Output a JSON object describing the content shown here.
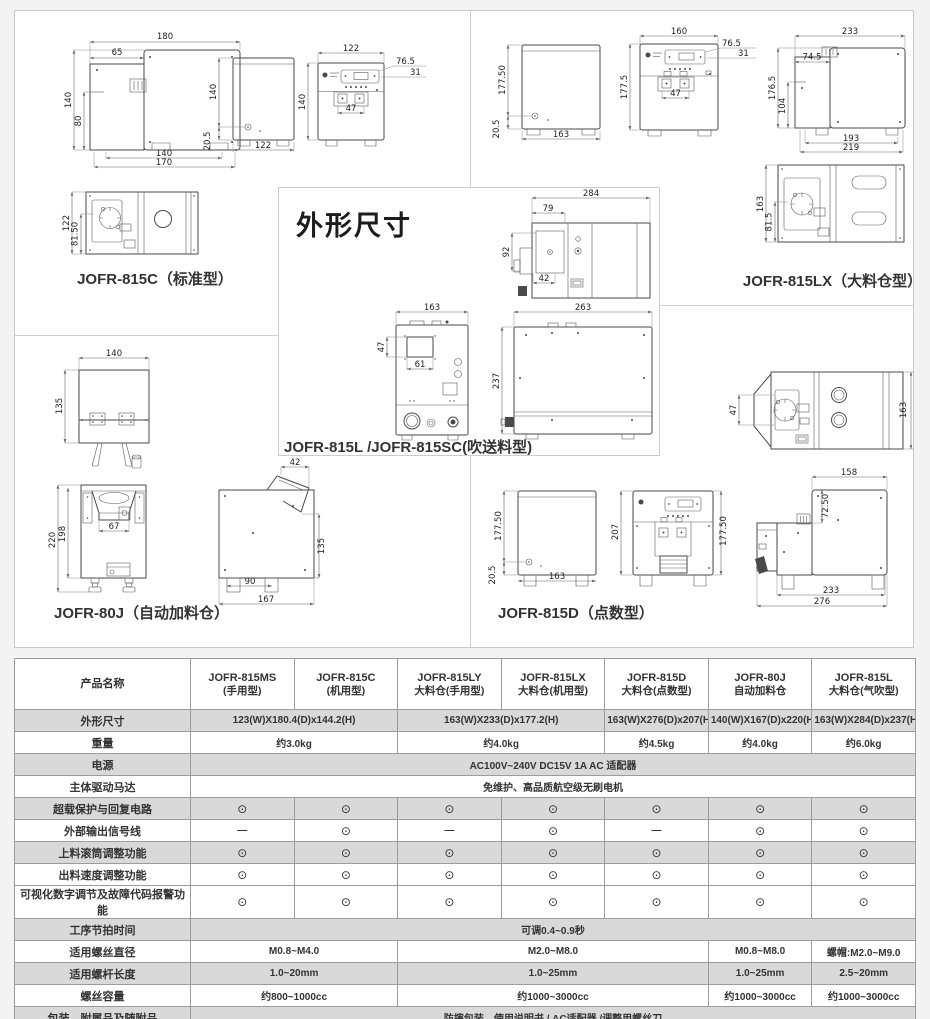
{
  "section_title": "外形尺寸",
  "labels": {
    "c815": "JOFR-815C（标准型）",
    "lx": "JOFR-815LX（大料仓型）",
    "l": "JOFR-815L /JOFR-815SC(吹送料型)",
    "j80": "JOFR-80J（自动加料仓）",
    "d815": "JOFR-815D（点数型）"
  },
  "dims": {
    "c815_side": {
      "top": "180",
      "upper": "65",
      "left": "140",
      "left2": "80",
      "bottom1": "140",
      "bottom2": "170"
    },
    "c815_rear": {
      "left": "140",
      "left2": "20.5",
      "bottom": "122"
    },
    "c815_front": {
      "top": "122",
      "right1": "76.5",
      "right2": "31",
      "left": "140",
      "inner": "47"
    },
    "c815_top": {
      "left": "122",
      "left2": "81.50"
    },
    "lx_rear": {
      "left": "177.50",
      "left2": "20.5",
      "bottom": "163"
    },
    "lx_front": {
      "top": "160",
      "right1": "76.5",
      "right2": "31",
      "left": "177.5",
      "inner": "47"
    },
    "lx_side": {
      "top": "233",
      "upper": "74.5",
      "left": "176.5",
      "left2": "104",
      "bottom1": "193",
      "bottom2": "219"
    },
    "lx_top": {
      "left": "163",
      "left2": "81.5"
    },
    "l_top": {
      "top": "284",
      "upper": "79",
      "left": "92",
      "lower": "42"
    },
    "l_front": {
      "top": "163",
      "left": "47",
      "inner": "61"
    },
    "l_side": {
      "top": "263",
      "left": "237"
    },
    "j80_top": {
      "top": "140",
      "left": "135"
    },
    "j80_front": {
      "left": "220",
      "left2": "198",
      "inner": "67"
    },
    "j80_side": {
      "top": "42",
      "right": "135",
      "bottom1": "90",
      "bottom2": "167"
    },
    "d815_top": {
      "left": "47",
      "right": "163"
    },
    "d815_rear": {
      "left": "177.50",
      "left2": "20.5",
      "bottom": "163"
    },
    "d815_front": {
      "left": "207",
      "right": "177.50"
    },
    "d815_side": {
      "top": "158",
      "inner": "72.50",
      "bottom1": "233",
      "bottom2": "276"
    }
  },
  "table": {
    "header": [
      {
        "l1": "产品名称",
        "l2": ""
      },
      {
        "l1": "JOFR-815MS",
        "l2": "(手用型)"
      },
      {
        "l1": "JOFR-815C",
        "l2": "(机用型)"
      },
      {
        "l1": "JOFR-815LY",
        "l2": "大料仓(手用型)"
      },
      {
        "l1": "JOFR-815LX",
        "l2": "大料仓(机用型)"
      },
      {
        "l1": "JOFR-815D",
        "l2": "大料仓(点数型)"
      },
      {
        "l1": "JOFR-80J",
        "l2": "自动加料仓"
      },
      {
        "l1": "JOFR-815L",
        "l2": "大料仓(气吹型)"
      }
    ],
    "rows": [
      {
        "label": "外形尺寸",
        "shaded": true,
        "cells": [
          {
            "t": "123(W)X180.4(D)x144.2(H)",
            "span": 2
          },
          {
            "t": "163(W)X233(D)x177.2(H)",
            "span": 2
          },
          {
            "t": "163(W)X276(D)x207(H)",
            "span": 1
          },
          {
            "t": "140(W)X167(D)x220(H)",
            "span": 1
          },
          {
            "t": "163(W)X284(D)x237(H)",
            "span": 1
          }
        ]
      },
      {
        "label": "重量",
        "shaded": false,
        "cells": [
          {
            "t": "约3.0kg",
            "span": 2
          },
          {
            "t": "约4.0kg",
            "span": 2
          },
          {
            "t": "约4.5kg",
            "span": 1
          },
          {
            "t": "约4.0kg",
            "span": 1
          },
          {
            "t": "约6.0kg",
            "span": 1
          }
        ]
      },
      {
        "label": "电源",
        "shaded": true,
        "cells": [
          {
            "t": "AC100V~240V DC15V 1A AC 适配器",
            "span": 7
          }
        ]
      },
      {
        "label": "主体驱动马达",
        "shaded": false,
        "cells": [
          {
            "t": "免维护、高品质航空级无刷电机",
            "span": 7
          }
        ]
      },
      {
        "label": "超载保护与回复电路",
        "shaded": true,
        "cells": [
          {
            "t": "⊙",
            "span": 1
          },
          {
            "t": "⊙",
            "span": 1
          },
          {
            "t": "⊙",
            "span": 1
          },
          {
            "t": "⊙",
            "span": 1
          },
          {
            "t": "⊙",
            "span": 1
          },
          {
            "t": "⊙",
            "span": 1
          },
          {
            "t": "⊙",
            "span": 1
          }
        ]
      },
      {
        "label": "外部输出信号线",
        "shaded": false,
        "cells": [
          {
            "t": "—",
            "span": 1
          },
          {
            "t": "⊙",
            "span": 1
          },
          {
            "t": "—",
            "span": 1
          },
          {
            "t": "⊙",
            "span": 1
          },
          {
            "t": "—",
            "span": 1
          },
          {
            "t": "⊙",
            "span": 1
          },
          {
            "t": "⊙",
            "span": 1
          }
        ]
      },
      {
        "label": "上料滚筒调整功能",
        "shaded": true,
        "cells": [
          {
            "t": "⊙",
            "span": 1
          },
          {
            "t": "⊙",
            "span": 1
          },
          {
            "t": "⊙",
            "span": 1
          },
          {
            "t": "⊙",
            "span": 1
          },
          {
            "t": "⊙",
            "span": 1
          },
          {
            "t": "⊙",
            "span": 1
          },
          {
            "t": "⊙",
            "span": 1
          }
        ]
      },
      {
        "label": "出料速度调整功能",
        "shaded": false,
        "cells": [
          {
            "t": "⊙",
            "span": 1
          },
          {
            "t": "⊙",
            "span": 1
          },
          {
            "t": "⊙",
            "span": 1
          },
          {
            "t": "⊙",
            "span": 1
          },
          {
            "t": "⊙",
            "span": 1
          },
          {
            "t": "⊙",
            "span": 1
          },
          {
            "t": "⊙",
            "span": 1
          }
        ]
      },
      {
        "label": "可视化数字调节及故障代码报警功能",
        "shaded": false,
        "cells": [
          {
            "t": "⊙",
            "span": 1
          },
          {
            "t": "⊙",
            "span": 1
          },
          {
            "t": "⊙",
            "span": 1
          },
          {
            "t": "⊙",
            "span": 1
          },
          {
            "t": "⊙",
            "span": 1
          },
          {
            "t": "⊙",
            "span": 1
          },
          {
            "t": "⊙",
            "span": 1
          }
        ]
      },
      {
        "label": "工序节拍时间",
        "shaded": true,
        "cells": [
          {
            "t": "可调0.4~0.9秒",
            "span": 7
          }
        ]
      },
      {
        "label": "适用螺丝直径",
        "shaded": false,
        "cells": [
          {
            "t": "M0.8~M4.0",
            "span": 2
          },
          {
            "t": "M2.0~M8.0",
            "span": 3
          },
          {
            "t": "M0.8~M8.0",
            "span": 1
          },
          {
            "t": "螺帽:M2.0~M9.0",
            "span": 1
          }
        ]
      },
      {
        "label": "适用螺杆长度",
        "shaded": true,
        "cells": [
          {
            "t": "1.0~20mm",
            "span": 2
          },
          {
            "t": "1.0~25mm",
            "span": 3
          },
          {
            "t": "1.0~25mm",
            "span": 1
          },
          {
            "t": "2.5~20mm",
            "span": 1
          }
        ]
      },
      {
        "label": "螺丝容量",
        "shaded": false,
        "cells": [
          {
            "t": "约800~1000cc",
            "span": 2
          },
          {
            "t": "约1000~3000cc",
            "span": 3
          },
          {
            "t": "约1000~3000cc",
            "span": 1
          },
          {
            "t": "约1000~3000cc",
            "span": 1
          }
        ]
      },
      {
        "label": "包装、附属品及随附品",
        "shaded": true,
        "cells": [
          {
            "t": "防摔包装、使用说明书 / AC适配器 /调整用螺丝刀",
            "span": 7
          }
        ]
      }
    ]
  },
  "colors": {
    "shaded_row": "#d9d9d9",
    "table_border": "#9c9c9c",
    "panel_border": "#cccccc",
    "text": "#333333",
    "drawing_line": "#4a4a4a"
  }
}
